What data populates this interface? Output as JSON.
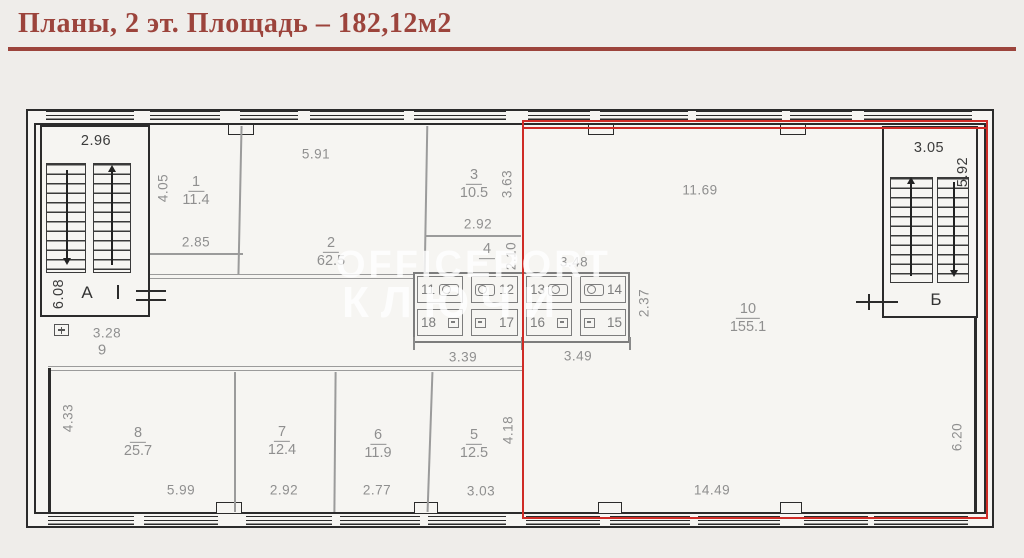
{
  "title": "Планы, 2 эт. Площадь – 182,12м2",
  "watermark": {
    "line1": "OFFICEPORT",
    "line2": "КЛЮЧИ"
  },
  "stairs": {
    "left_label": "А",
    "right_label": "Б"
  },
  "rooms": {
    "r1": {
      "num": "1",
      "area": "11.4"
    },
    "r2": {
      "num": "2",
      "area": "62.5"
    },
    "r3": {
      "num": "3",
      "area": "10.5"
    },
    "r4": {
      "num": "4",
      "area": ""
    },
    "r5": {
      "num": "5",
      "area": "12.5"
    },
    "r6": {
      "num": "6",
      "area": "11.9"
    },
    "r7": {
      "num": "7",
      "area": "12.4"
    },
    "r8": {
      "num": "8",
      "area": "25.7"
    },
    "r9": {
      "num": "9"
    },
    "r10": {
      "num": "10",
      "area": "155.1"
    }
  },
  "dims": {
    "stair_a_width": "2.96",
    "stair_a_height": "6.08",
    "entry_a": "3.28",
    "stair_b_width": "3.05",
    "stair_b_height": "5.92",
    "r1_depth": "4.05",
    "r1_width": "2.85",
    "r2_width": "5.91",
    "r3_depth": "3.63",
    "r3_width": "2.92",
    "r4_depth": "2.10",
    "wc_width": "3.48",
    "wc_depth": "2.37",
    "wc_left": "3.39",
    "wc_right": "3.49",
    "r10_top": "11.69",
    "r10_bottom": "14.49",
    "r10_right": "6.20",
    "r8_depth": "4.33",
    "r8_width": "5.99",
    "r7_width": "2.92",
    "r6_width": "2.77",
    "r5_width": "3.03",
    "r5_depth": "4.18"
  },
  "wc": {
    "top": [
      "11",
      "12",
      "13",
      "14"
    ],
    "bottom": [
      "18",
      "17",
      "16",
      "15"
    ]
  },
  "colors": {
    "accent": "#9c443c",
    "highlight_red": "#cf2b26",
    "wall": "#2b2b2b",
    "partition": "#9b9b9b",
    "dim_text": "#8f8f8f",
    "dark_text": "#3b3b3b",
    "paper": "#f6f5f2",
    "page_bg": "#efedea"
  }
}
